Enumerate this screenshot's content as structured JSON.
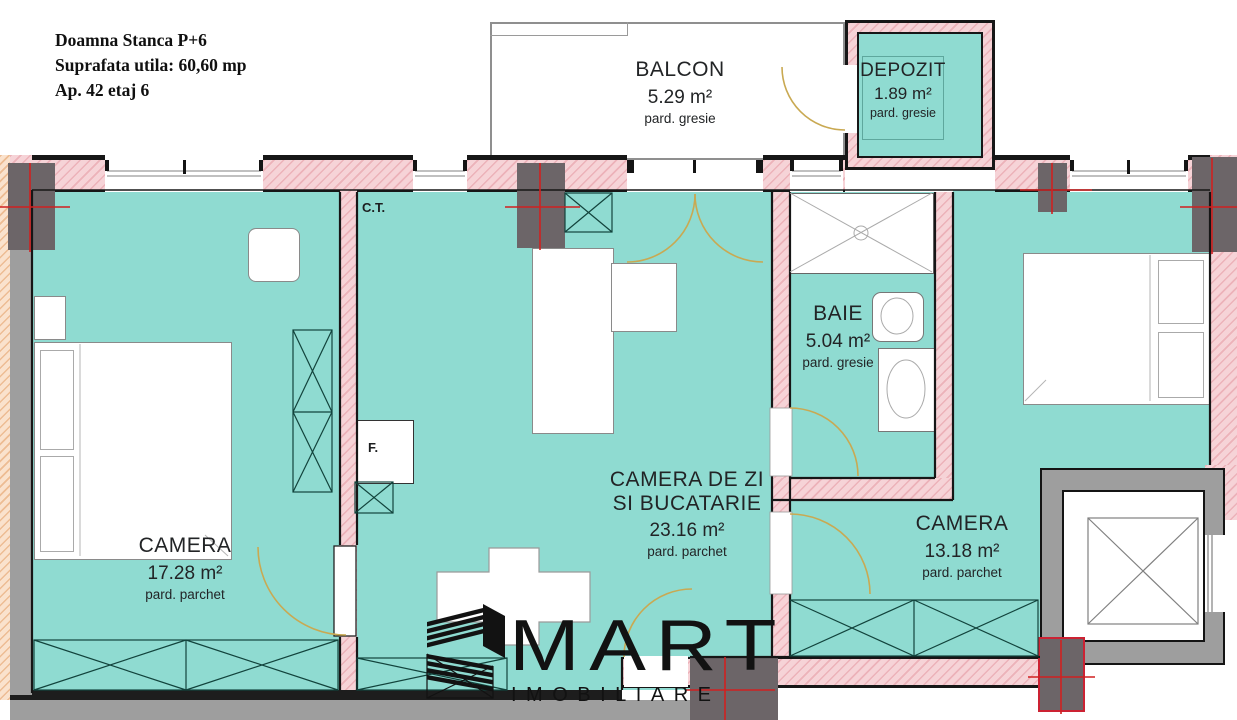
{
  "header": {
    "line1": "Doamna Stanca P+6",
    "line2": "Suprafata utila: 60,60 mp",
    "line3": "Ap. 42 etaj 6"
  },
  "rooms": {
    "balcon": {
      "name": "BALCON",
      "area": "5.29 m²",
      "floor": "pard. gresie"
    },
    "depozit": {
      "name": "DEPOZIT",
      "area": "1.89 m²",
      "floor": "pard. gresie"
    },
    "baie": {
      "name": "BAIE",
      "area": "5.04 m²",
      "floor": "pard. gresie"
    },
    "camera1": {
      "name": "CAMERA",
      "area": "17.28 m²",
      "floor": "pard. parchet"
    },
    "living": {
      "name_line1": "CAMERA DE ZI",
      "name_line2": "SI BUCATARIE",
      "area": "23.16 m²",
      "floor": "pard. parchet"
    },
    "camera2": {
      "name": "CAMERA",
      "area": "13.18 m²",
      "floor": "pard. parchet"
    }
  },
  "annotations": {
    "ct": "C.T.",
    "f": "F."
  },
  "logo": {
    "name": "MART",
    "subtitle": "IMOBILIARE"
  },
  "colors": {
    "room_fill": "#8fdbd1",
    "wall_fill": "#f6d3d7",
    "wall_hatch": "#e496a0",
    "column": "#6c6568",
    "accent_red": "#d02020",
    "gray": "#9e9e9e",
    "door_arc": "#c9a952"
  }
}
